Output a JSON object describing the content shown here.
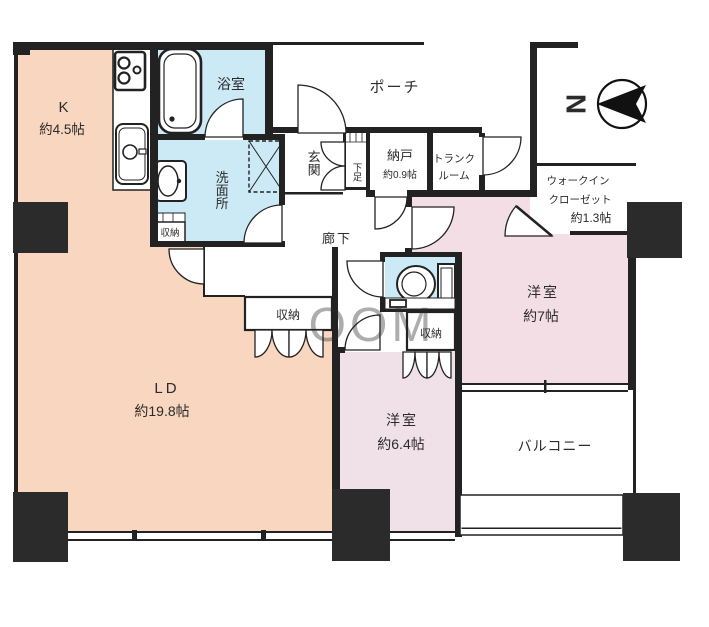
{
  "plan": {
    "rooms": {
      "kitchen": {
        "label": "K",
        "size": "約4.5帖"
      },
      "bath": {
        "label": "浴室"
      },
      "washroom": {
        "label": "洗面所"
      },
      "washroom_storage": {
        "label": "収納"
      },
      "porch": {
        "label": "ポーチ"
      },
      "entrance": {
        "label": "玄関"
      },
      "shoe_cabinet": {
        "label": "下足"
      },
      "storeroom": {
        "label": "納戸",
        "size": "約0.9帖"
      },
      "trunk": {
        "line1": "トランク",
        "line2": "ルーム"
      },
      "corridor": {
        "label": "廊下"
      },
      "wic": {
        "line1": "ウォークイン",
        "line2": "クローゼット",
        "line3": "約1.3帖"
      },
      "bedroom7": {
        "label": "洋室",
        "size": "約7帖"
      },
      "bedroom7_storage": {
        "label": "収納"
      },
      "ld": {
        "label": "LD",
        "size": "約19.8帖"
      },
      "ld_storage": {
        "label": "収納"
      },
      "bedroom6": {
        "label": "洋室",
        "size": "約6.4帖"
      },
      "balcony": {
        "label": "バルコニー"
      }
    },
    "compass": {
      "label": "N"
    },
    "watermark": {
      "text": "OOM"
    },
    "colors": {
      "living_dining": "#F8D6BF",
      "bedroom_main": "#F4DEE5",
      "bedroom_second": "#F0E1E9",
      "wet_area": "#CCE9F6",
      "wall": "#222222"
    }
  }
}
